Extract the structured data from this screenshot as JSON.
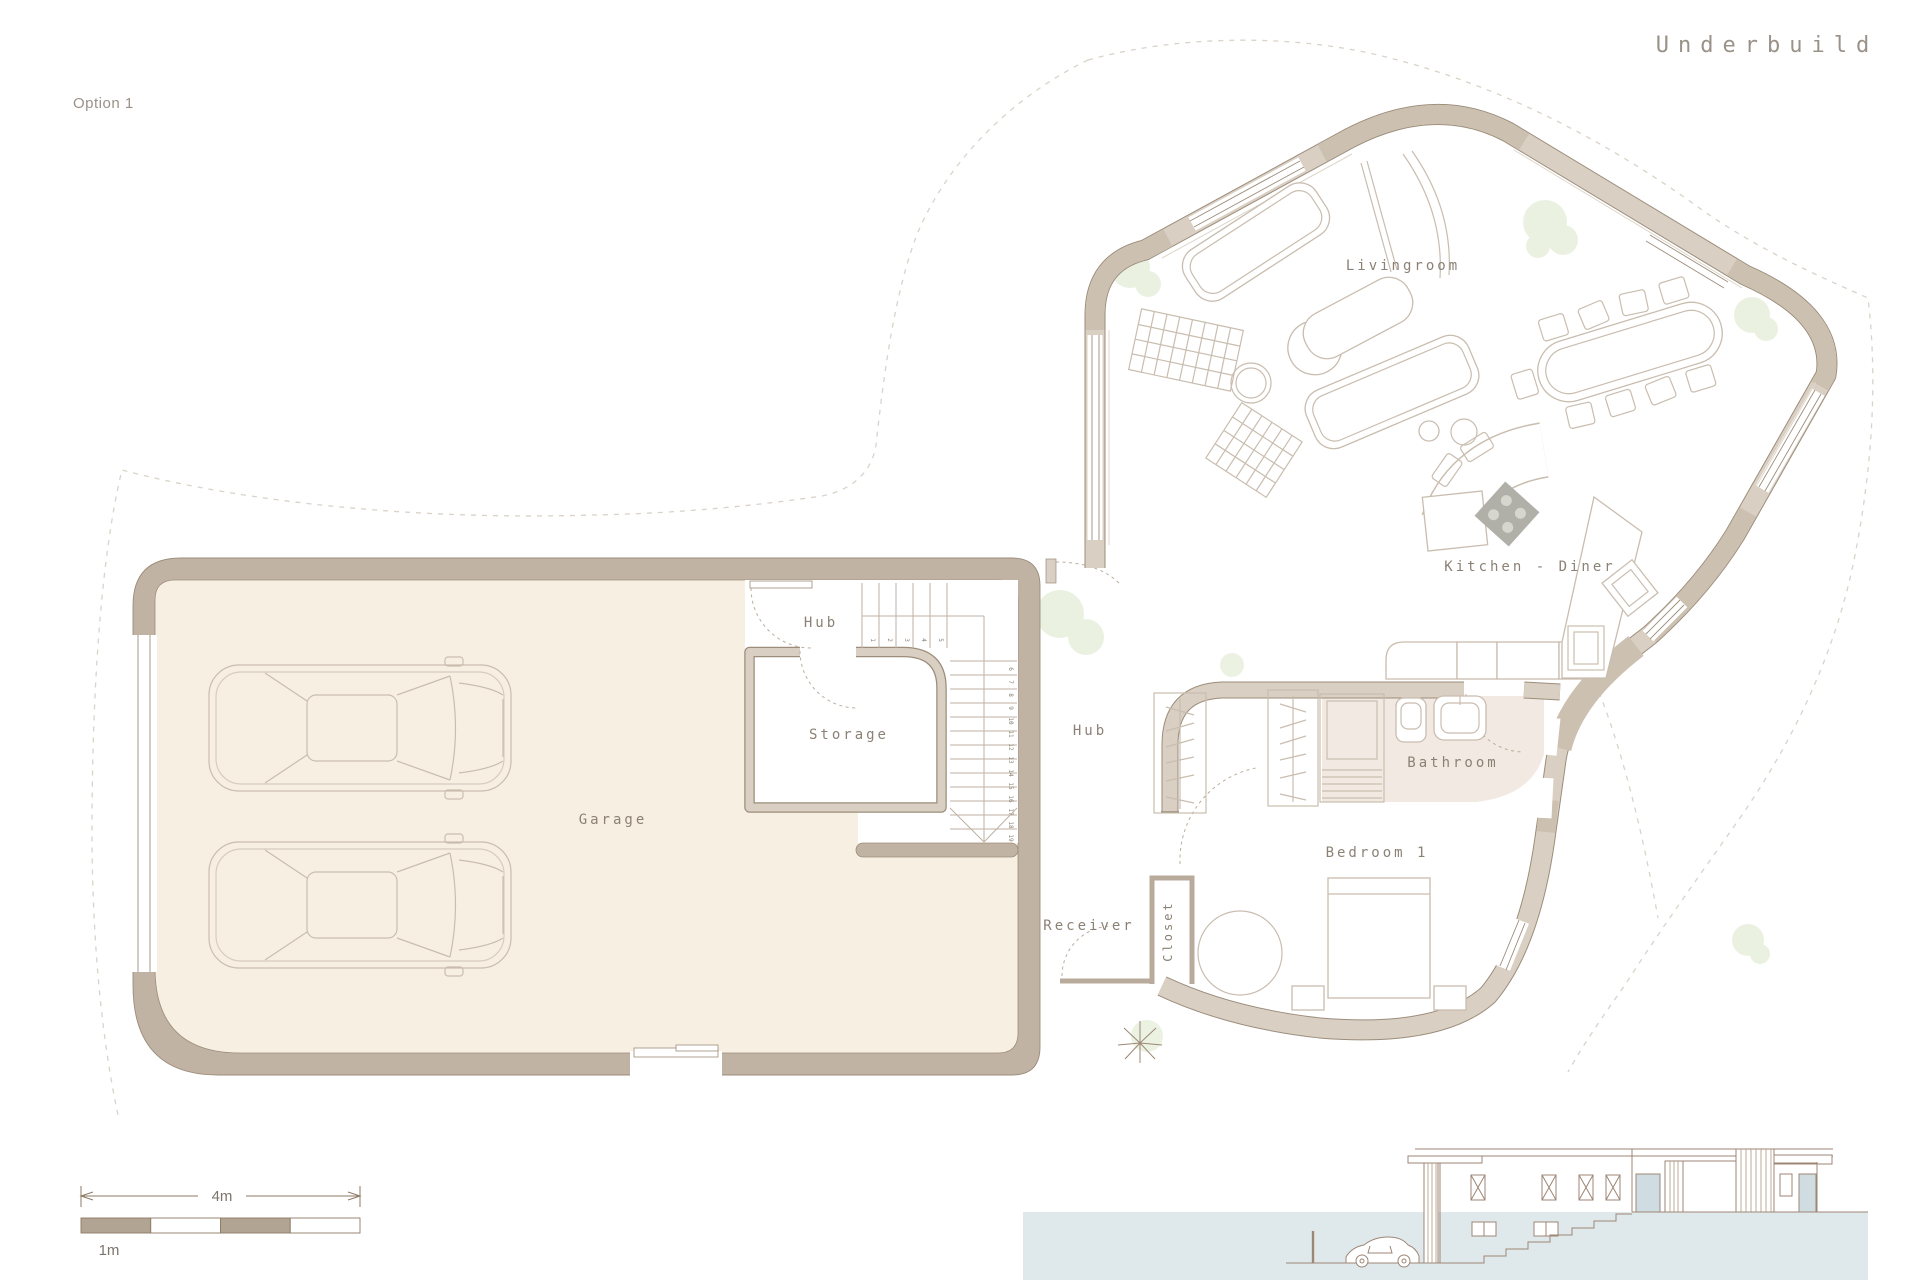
{
  "title": "Underbuild",
  "option_label": "Option 1",
  "rooms": {
    "livingroom": "Livingroom",
    "kitchen_diner": "Kitchen - Diner",
    "hub_upper": "Hub",
    "hub_lower": "Hub",
    "storage": "Storage",
    "garage": "Garage",
    "bathroom": "Bathroom",
    "bedroom": "Bedroom 1",
    "receiver": "Receiver",
    "closet": "Closet"
  },
  "stairs": {
    "numbers": [
      "1",
      "2",
      "3",
      "4",
      "5",
      "6",
      "7",
      "8",
      "9",
      "10",
      "11",
      "12",
      "13",
      "14",
      "15",
      "16",
      "17",
      "18",
      "19"
    ]
  },
  "scale_bar": {
    "total_label": "4m",
    "unit_label": "1m"
  },
  "colors": {
    "wall-garage": "#c1b3a4",
    "garage-fill": "#f8efe3",
    "wall-main": "#d9cfc3",
    "wall-corner": "#ccc0b1",
    "ink": "#9c8d7b",
    "furn": "#c9bdaf",
    "label": "#8b8175",
    "label-light": "#9a9288",
    "bath-tint": "#f2eae2",
    "ground": "#dfe9ec",
    "glass": "#cfdde2",
    "tree": "#e4edd8",
    "scale-tan": "#b2a493",
    "cooktop": "#b1b0a8",
    "dash": "#d9d3c9",
    "elev": "#9c8674"
  }
}
